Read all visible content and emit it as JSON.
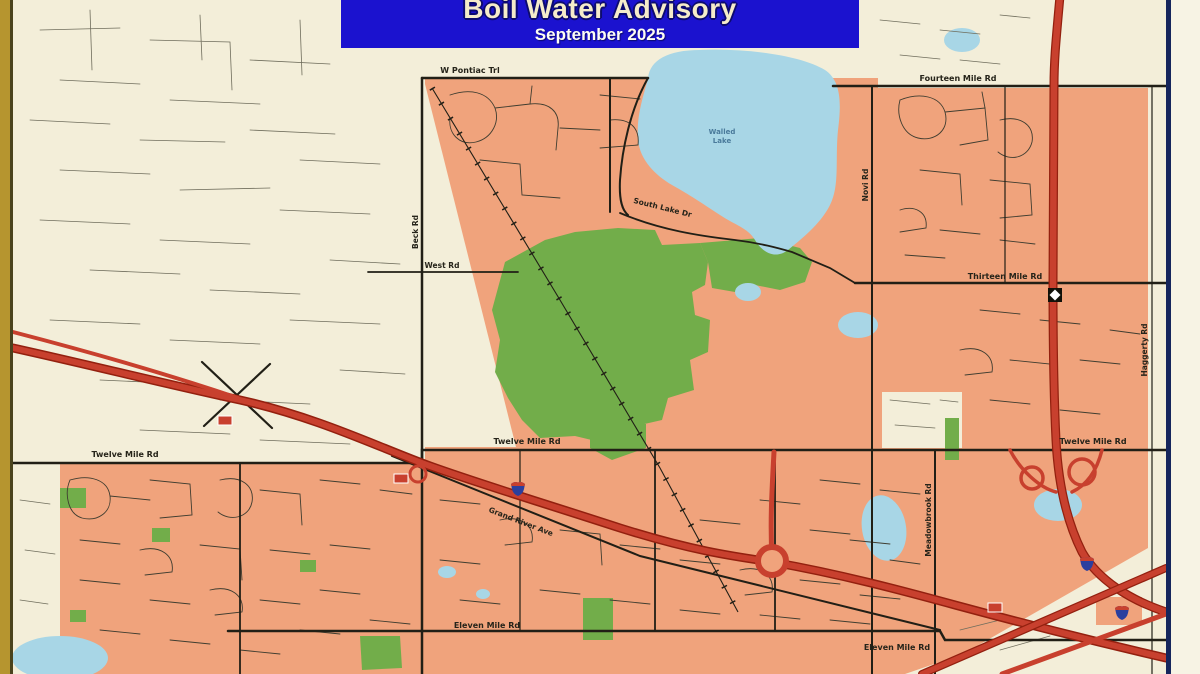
{
  "banner": {
    "title": "Boil Water Advisory",
    "subtitle": "September 2025"
  },
  "map": {
    "labels": {
      "pontiac_trl": "W Pontiac Trl",
      "fourteen_mile": "Fourteen Mile Rd",
      "thirteen_mile": "Thirteen Mile Rd",
      "twelve_mile": "Twelve Mile Rd",
      "eleven_mile": "Eleven Mile Rd",
      "beck_rd": "Beck Rd",
      "west_rd": "West Rd",
      "south_lake_dr": "South Lake Dr",
      "walled_lake_line1": "Walled",
      "walled_lake_line2": "Lake",
      "novi_rd": "Novi Rd",
      "meadowbrook_rd": "Meadowbrook Rd",
      "haggerty_rd": "Haggerty Rd",
      "grand_river_ave": "Grand River Ave"
    },
    "colors": {
      "advisory_area": "#f0a37c",
      "unaffected_area": "#f3eed9",
      "water": "#a8d6e6",
      "park": "#72ad4a",
      "road": "#211f16",
      "highway": "#c8402e",
      "banner_bg": "#1b12cf",
      "border_gold": "#b6952f",
      "border_navy": "#15255c"
    },
    "icons": [
      "interstate-shield-icon",
      "business-route-marker-icon",
      "m5-route-marker-icon"
    ]
  }
}
